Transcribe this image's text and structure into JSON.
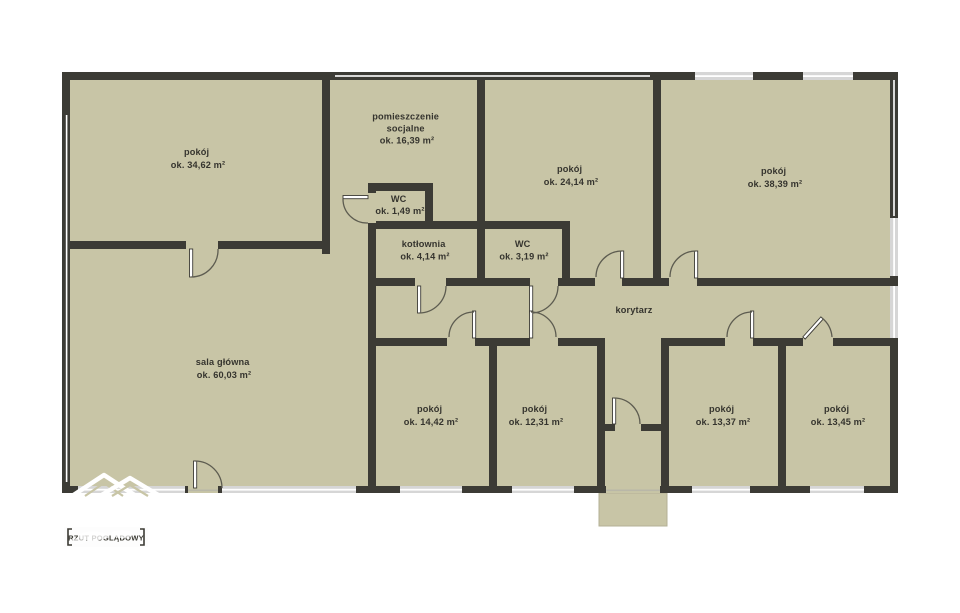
{
  "plan": {
    "title_stamp": "RZUT POGLĄDOWY",
    "watermark_icon": "mountain-peaks-logo",
    "colors": {
      "room_fill": "#c8c5a6",
      "wall": "#3c3b35",
      "window": "#d6d6d6",
      "label_text": "#35342e",
      "background": "#ffffff"
    },
    "rooms": [
      {
        "name": "pokój",
        "area_label": "ok. 34,62 m²"
      },
      {
        "name": "pomieszczenie socjalne",
        "name_lines": [
          "pomieszczenie",
          "socjalne"
        ],
        "area_label": "ok. 16,39 m²"
      },
      {
        "name": "pokój",
        "area_label": "ok. 24,14 m²"
      },
      {
        "name": "pokój",
        "area_label": "ok. 38,39 m²"
      },
      {
        "name": "WC",
        "area_label": "ok. 1,49 m²"
      },
      {
        "name": "kotłownia",
        "area_label": "ok. 4,14 m²"
      },
      {
        "name": "WC",
        "area_label": "ok. 3,19 m²"
      },
      {
        "name": "korytarz"
      },
      {
        "name": "sala główna",
        "area_label": "ok. 60,03 m²"
      },
      {
        "name": "pokój",
        "area_label": "ok. 14,42 m²"
      },
      {
        "name": "pokój",
        "area_label": "ok. 12,31 m²"
      },
      {
        "name": "pokój",
        "area_label": "ok. 13,37 m²"
      },
      {
        "name": "pokój",
        "area_label": "ok. 13,45 m²"
      }
    ]
  }
}
